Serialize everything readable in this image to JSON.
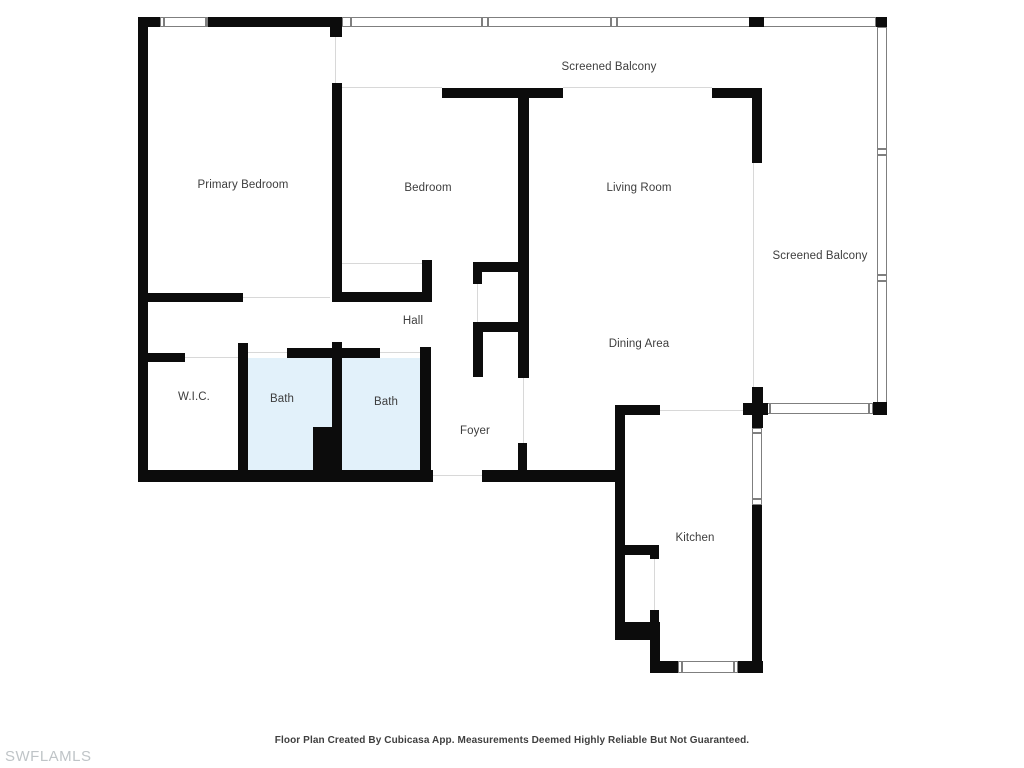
{
  "footer": {
    "text": "Floor Plan Created By Cubicasa App. Measurements Deemed Highly Reliable But Not Guaranteed."
  },
  "watermark": {
    "text": "SWFLAMLS"
  },
  "floorplan": {
    "colors": {
      "wall": "#0c0c0c",
      "window_border": "#7f7f7f",
      "thin_line": "#d8d8d8",
      "bath_fill": "#e2f1fa",
      "label": "#3d3d3d",
      "footer": "#3f3f3f",
      "watermark": "#bfc4c7"
    },
    "rooms": [
      {
        "id": "screened-balcony-top",
        "label": "Screened Balcony",
        "x": 609,
        "y": 67
      },
      {
        "id": "primary-bedroom",
        "label": "Primary Bedroom",
        "x": 243,
        "y": 185
      },
      {
        "id": "bedroom",
        "label": "Bedroom",
        "x": 428,
        "y": 188
      },
      {
        "id": "living-room",
        "label": "Living Room",
        "x": 639,
        "y": 188
      },
      {
        "id": "screened-balcony-right",
        "label": "Screened Balcony",
        "x": 820,
        "y": 256
      },
      {
        "id": "hall",
        "label": "Hall",
        "x": 413,
        "y": 321
      },
      {
        "id": "dining-area",
        "label": "Dining Area",
        "x": 639,
        "y": 344
      },
      {
        "id": "wic",
        "label": "W.I.C.",
        "x": 194,
        "y": 397
      },
      {
        "id": "bath-1",
        "label": "Bath",
        "x": 282,
        "y": 399
      },
      {
        "id": "bath-2",
        "label": "Bath",
        "x": 386,
        "y": 402
      },
      {
        "id": "foyer",
        "label": "Foyer",
        "x": 475,
        "y": 431
      },
      {
        "id": "kitchen",
        "label": "Kitchen",
        "x": 695,
        "y": 538
      }
    ],
    "fills": [
      [
        248,
        358,
        84,
        112
      ],
      [
        342,
        358,
        78,
        112
      ]
    ],
    "walls": [
      [
        138,
        17,
        10,
        465
      ],
      [
        138,
        17,
        22,
        10
      ],
      [
        208,
        17,
        134,
        10
      ],
      [
        330,
        27,
        12,
        10
      ],
      [
        332,
        83,
        10,
        219
      ],
      [
        442,
        88,
        121,
        10
      ],
      [
        712,
        88,
        50,
        10
      ],
      [
        752,
        98,
        10,
        65
      ],
      [
        518,
        97,
        11,
        281
      ],
      [
        338,
        292,
        94,
        10
      ],
      [
        422,
        260,
        10,
        42
      ],
      [
        473,
        262,
        46,
        10
      ],
      [
        473,
        272,
        9,
        12
      ],
      [
        477,
        322,
        42,
        10
      ],
      [
        473,
        322,
        10,
        55
      ],
      [
        147,
        293,
        96,
        9
      ],
      [
        147,
        353,
        38,
        9
      ],
      [
        238,
        343,
        10,
        137
      ],
      [
        287,
        348,
        45,
        10
      ],
      [
        332,
        342,
        10,
        138
      ],
      [
        342,
        348,
        38,
        10
      ],
      [
        420,
        347,
        11,
        133
      ],
      [
        313,
        427,
        25,
        46
      ],
      [
        138,
        470,
        295,
        12
      ],
      [
        482,
        470,
        133,
        12
      ],
      [
        518,
        443,
        9,
        33
      ],
      [
        615,
        405,
        45,
        10
      ],
      [
        615,
        405,
        10,
        235
      ],
      [
        625,
        545,
        34,
        10
      ],
      [
        650,
        545,
        9,
        14
      ],
      [
        650,
        610,
        9,
        12
      ],
      [
        615,
        622,
        45,
        18
      ],
      [
        650,
        640,
        10,
        33
      ],
      [
        650,
        661,
        28,
        12
      ],
      [
        738,
        661,
        25,
        12
      ],
      [
        752,
        505,
        10,
        168
      ],
      [
        752,
        387,
        11,
        41
      ],
      [
        743,
        403,
        25,
        12
      ],
      [
        873,
        402,
        14,
        13
      ],
      [
        876,
        17,
        11,
        10
      ],
      [
        749,
        17,
        15,
        10
      ]
    ],
    "windows": [
      [
        160,
        17,
        48,
        10
      ],
      [
        342,
        17,
        534,
        10
      ],
      [
        877,
        27,
        10,
        376
      ],
      [
        767,
        403,
        106,
        11
      ],
      [
        752,
        428,
        10,
        77
      ],
      [
        678,
        661,
        60,
        12
      ]
    ],
    "ticks": [
      [
        163,
        17,
        2,
        10
      ],
      [
        205,
        17,
        2,
        10
      ],
      [
        350,
        17,
        2,
        10
      ],
      [
        481,
        17,
        2,
        10
      ],
      [
        487,
        17,
        2,
        10
      ],
      [
        610,
        17,
        2,
        10
      ],
      [
        616,
        17,
        2,
        10
      ],
      [
        877,
        148,
        10,
        2
      ],
      [
        877,
        154,
        10,
        2
      ],
      [
        877,
        274,
        10,
        2
      ],
      [
        877,
        280,
        10,
        2
      ],
      [
        769,
        403,
        2,
        11
      ],
      [
        868,
        403,
        2,
        11
      ],
      [
        752,
        432,
        10,
        2
      ],
      [
        752,
        498,
        10,
        2
      ],
      [
        681,
        661,
        2,
        12
      ],
      [
        733,
        661,
        2,
        12
      ]
    ],
    "lines": [
      [
        335,
        37,
        1,
        46
      ],
      [
        342,
        87,
        100,
        1
      ],
      [
        563,
        87,
        149,
        1
      ],
      [
        753,
        163,
        1,
        224
      ],
      [
        342,
        263,
        80,
        1
      ],
      [
        243,
        297,
        87,
        1
      ],
      [
        248,
        352,
        39,
        1
      ],
      [
        380,
        352,
        40,
        1
      ],
      [
        185,
        357,
        53,
        1
      ],
      [
        477,
        282,
        1,
        40
      ],
      [
        433,
        475,
        49,
        1
      ],
      [
        523,
        378,
        1,
        65
      ],
      [
        654,
        559,
        1,
        51
      ],
      [
        660,
        410,
        83,
        1
      ]
    ]
  }
}
